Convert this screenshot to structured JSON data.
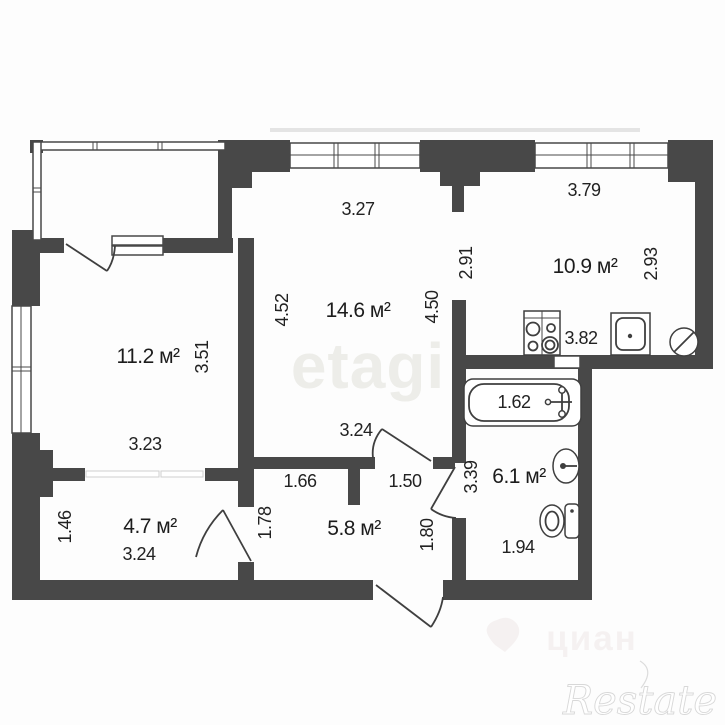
{
  "plan": {
    "rooms": {
      "living": {
        "area": "14.6 м²"
      },
      "bedroom": {
        "area": "11.2 м²"
      },
      "kitchen": {
        "area": "10.9 м²"
      },
      "cabinet": {
        "area": "4.7 м²"
      },
      "hallway": {
        "area": "5.8 м²"
      },
      "bathroom": {
        "area": "6.1 м²"
      }
    },
    "dims": {
      "living_top": "3.27",
      "living_left": "4.52",
      "living_right": "4.50",
      "living_bottom": "3.24",
      "kitchen_top": "3.79",
      "kitchen_left": "2.91",
      "kitchen_right": "2.93",
      "kitchen_bottom": "3.82",
      "bedroom_right": "3.51",
      "bedroom_bottom": "3.23",
      "cabinet_left": "1.46",
      "cabinet_bottom": "3.24",
      "hallway_top_left": "1.66",
      "hallway_top_right": "1.50",
      "hallway_left": "1.78",
      "hallway_right": "1.80",
      "bathroom_left": "3.39",
      "bathroom_bottom": "1.94",
      "bathtub_length": "1.62"
    },
    "fixtures": {
      "stove": "stove-icon",
      "kitchen_sink": "kitchen-sink-icon",
      "appliance": "appliance-circle-icon",
      "bathtub": "bathtub-icon",
      "washbasin": "washbasin-icon",
      "toilet": "toilet-icon"
    },
    "colors": {
      "wall": "#484848",
      "text": "#222222",
      "watermark_center": "#edede9",
      "watermark_portal": "#f5f1f1",
      "watermark_brand": "#d8d8d8"
    }
  },
  "watermarks": {
    "agency": "etagi",
    "portal": "циан",
    "brand": "Restate"
  }
}
